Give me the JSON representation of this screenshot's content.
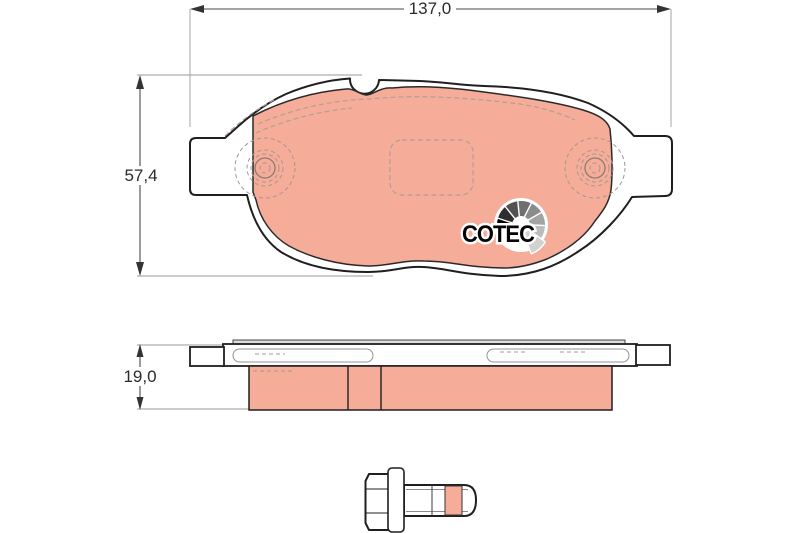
{
  "page": {
    "background": "#ffffff"
  },
  "dimensions": {
    "width": {
      "label": "137,0"
    },
    "height": {
      "label": "57,4"
    },
    "thickness": {
      "label": "19,0"
    }
  },
  "logo": {
    "text": "COTEC",
    "fan_colors": [
      "#000000",
      "#2e2e2e",
      "#515151",
      "#6f6f6f",
      "#8c8c8c",
      "#a3a3a3",
      "#bcbcbc",
      "#d2d2d2"
    ]
  },
  "colors": {
    "friction": "#f5ad9a",
    "outline": "#1f1f1f",
    "dimension_line": "#4a4a4a",
    "hidden_line": "#b39d94",
    "plate_fill": "#ffffff"
  }
}
